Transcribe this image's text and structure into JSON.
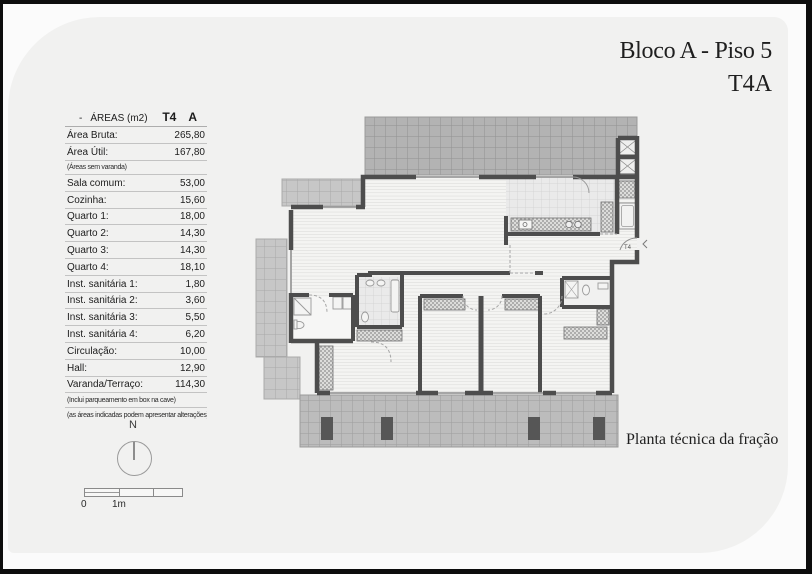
{
  "page": {
    "title_line1": "Bloco A - Piso 5",
    "title_line2": "T4A",
    "caption": "Planta técnica da fração"
  },
  "areas_table": {
    "header": {
      "dash": "-",
      "title": "ÁREAS (m2)",
      "type": "T4",
      "block": "A"
    },
    "rows": [
      {
        "label": "Área Bruta:",
        "value": "265,80"
      },
      {
        "label": "Área Útil:",
        "value": "167,80"
      },
      {
        "note": "(Áreas sem varanda)"
      },
      {
        "label": "Sala comum:",
        "value": "53,00"
      },
      {
        "label": "Cozinha:",
        "value": "15,60"
      },
      {
        "label": "Quarto 1:",
        "value": "18,00"
      },
      {
        "label": "Quarto 2:",
        "value": "14,30"
      },
      {
        "label": "Quarto 3:",
        "value": "14,30"
      },
      {
        "label": "Quarto 4:",
        "value": "18,10"
      },
      {
        "label": "Inst. sanitária 1:",
        "value": "1,80"
      },
      {
        "label": "Inst. sanitária 2:",
        "value": "3,60"
      },
      {
        "label": "Inst. sanitária 3:",
        "value": "5,50"
      },
      {
        "label": "Inst. sanitária 4:",
        "value": "6,20"
      },
      {
        "label": "Circulação:",
        "value": "10,00"
      },
      {
        "label": "Hall:",
        "value": "12,90"
      },
      {
        "label": "Varanda/Terraço:",
        "value": "114,30"
      },
      {
        "note": "(Inclui parqueamento em box na cave)"
      },
      {
        "note": "(as áreas indicadas podem apresentar alterações)"
      }
    ]
  },
  "compass": {
    "label": "N"
  },
  "scale_bar": {
    "zero": "0",
    "one_meter": "1m"
  },
  "plan": {
    "entrance_label": "T4"
  },
  "colors": {
    "frame": "#0d0d0d",
    "page_background": "#f1f1f0",
    "wall": "#4d4d4d",
    "terrace_dark": "#b3b3b3",
    "terrace_light": "#c7c7c7",
    "terrace_mid": "#bcbcbc",
    "kitchen_tile": "#eaeaea",
    "wood_floor": "#f4f4f2"
  }
}
